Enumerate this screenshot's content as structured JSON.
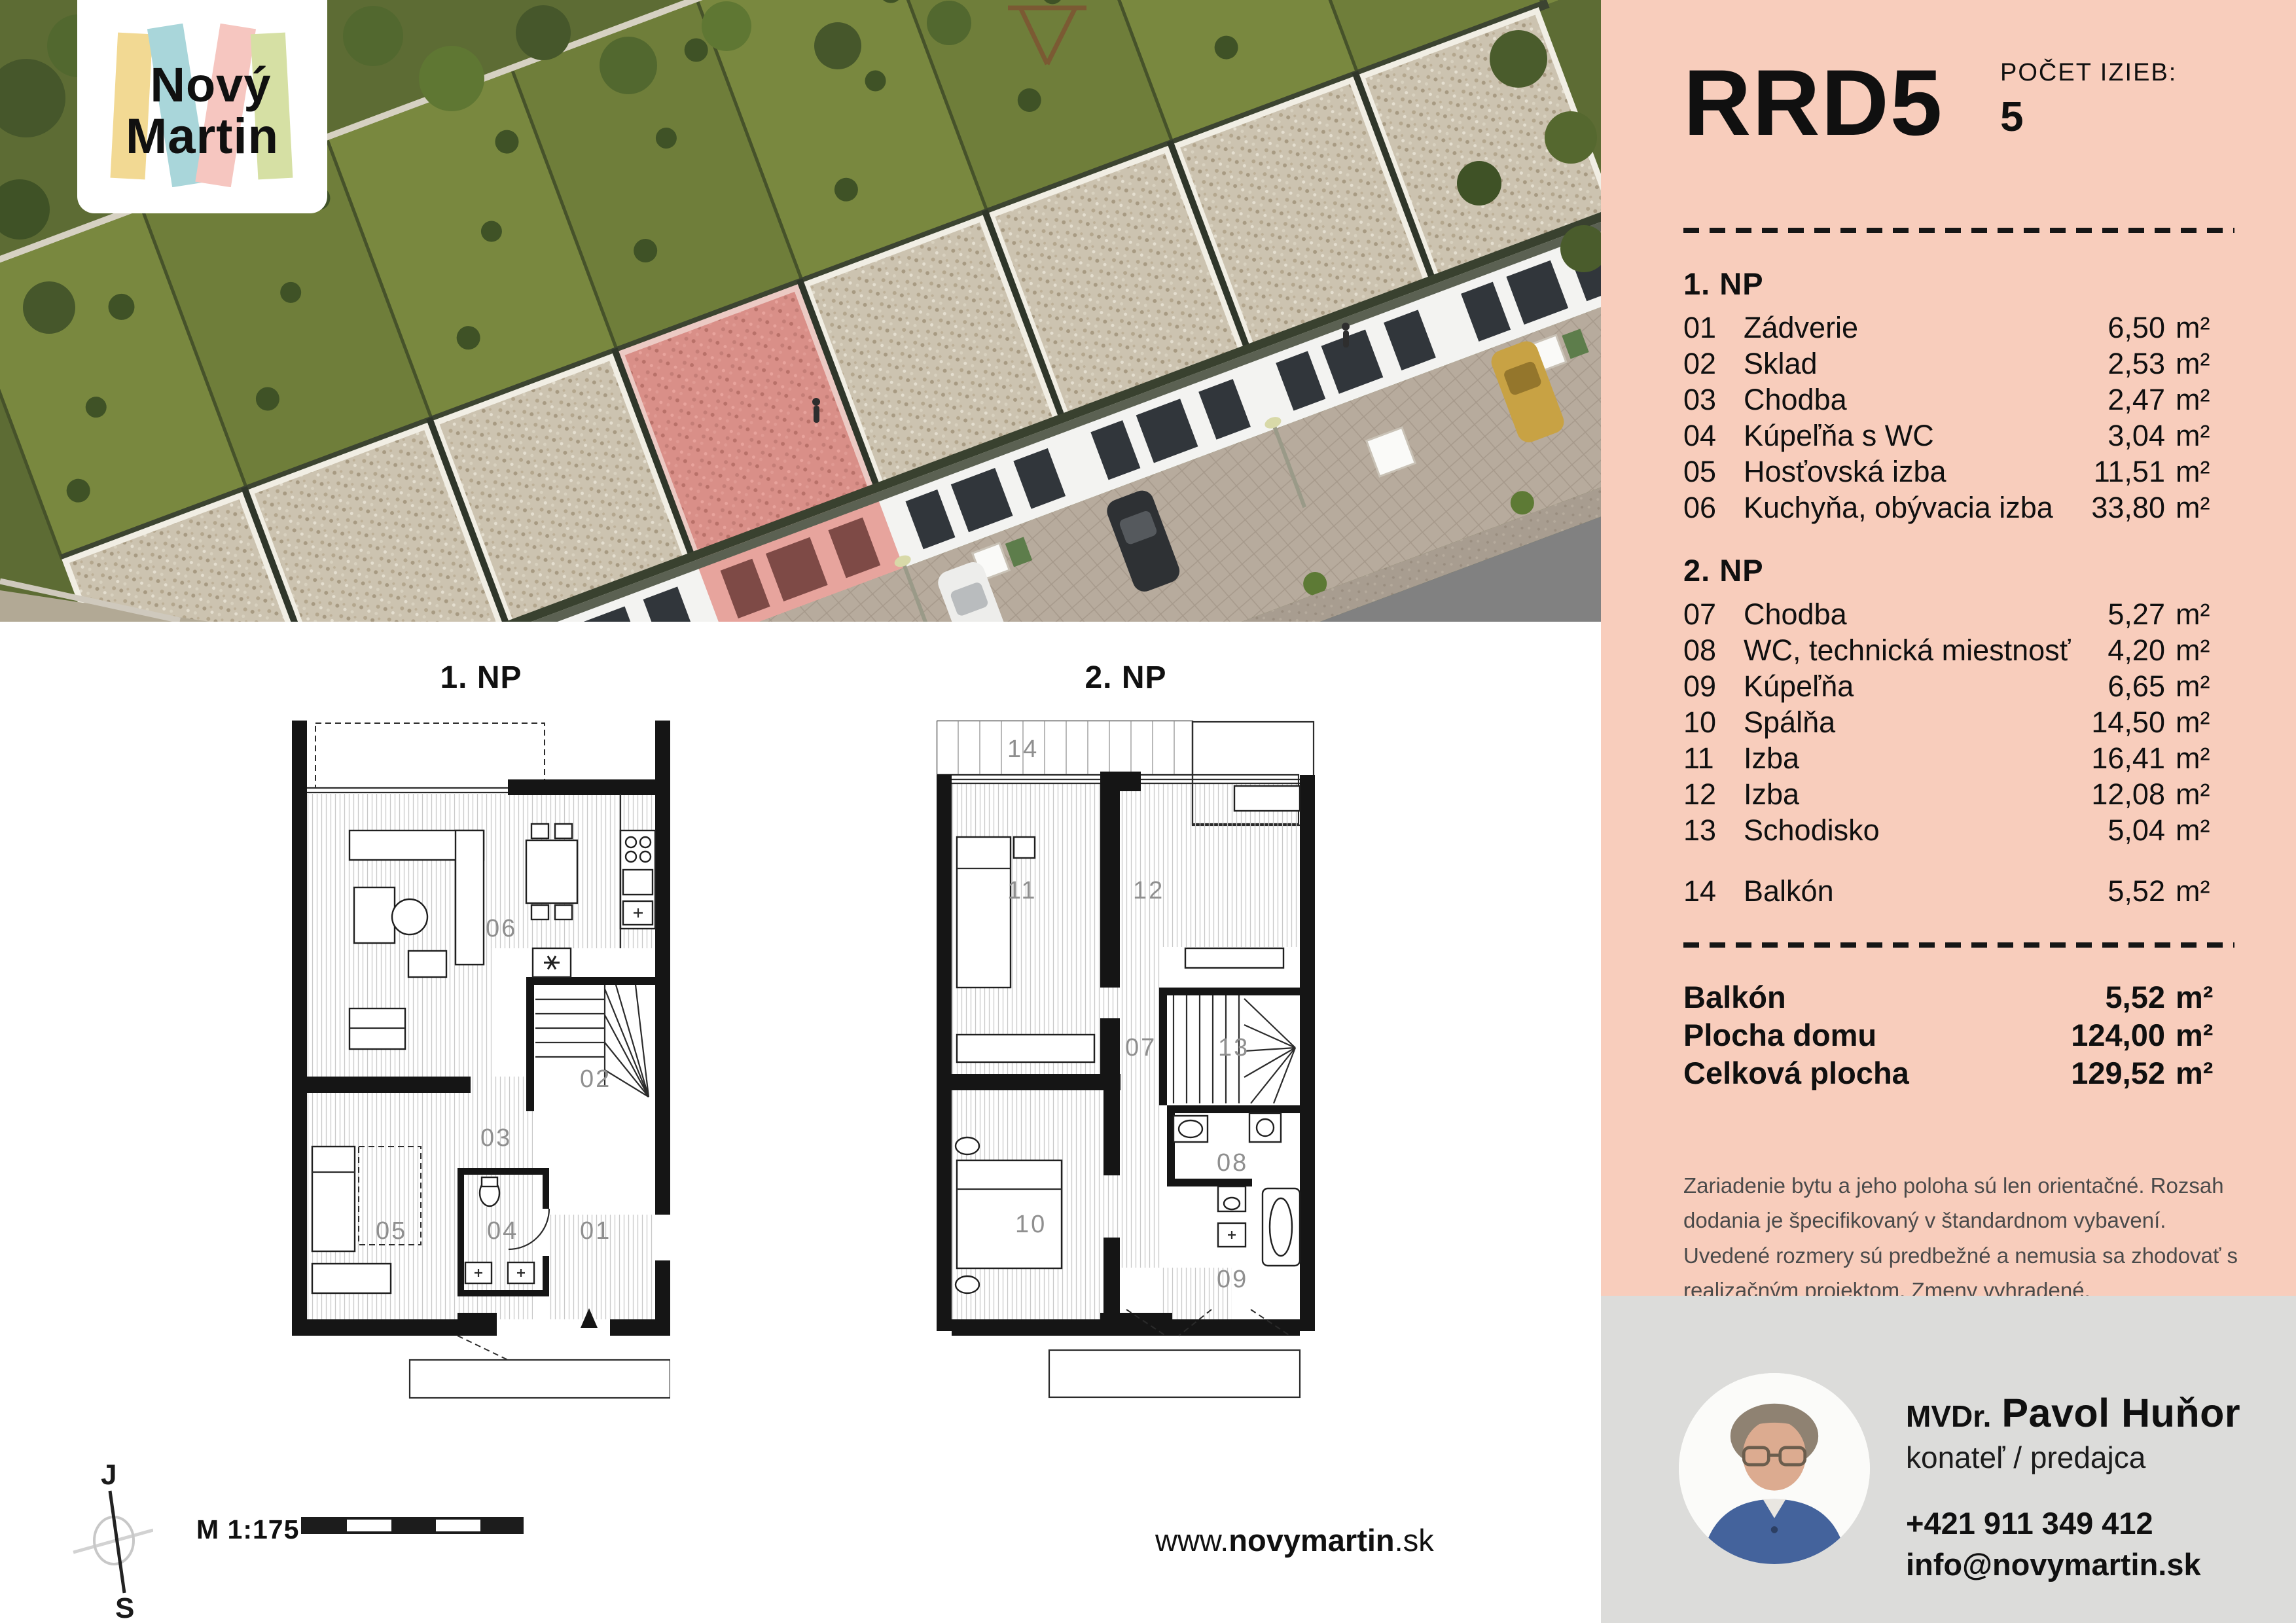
{
  "brand": {
    "name_line1": "Nový",
    "name_line2": "Martin"
  },
  "unit_header": {
    "code": "RRD5",
    "rooms_label": "POČET IZIEB:",
    "rooms_count": "5"
  },
  "area_unit": "m²",
  "floor1": {
    "title": "1. NP",
    "rows": [
      {
        "num": "01",
        "name": "Zádverie",
        "area": "6,50"
      },
      {
        "num": "02",
        "name": "Sklad",
        "area": "2,53"
      },
      {
        "num": "03",
        "name": "Chodba",
        "area": "2,47"
      },
      {
        "num": "04",
        "name": "Kúpeľňa s WC",
        "area": "3,04"
      },
      {
        "num": "05",
        "name": "Hosťovská izba",
        "area": "11,51"
      },
      {
        "num": "06",
        "name": "Kuchyňa, obývacia izba",
        "area": "33,80"
      }
    ]
  },
  "floor2": {
    "title": "2. NP",
    "rows": [
      {
        "num": "07",
        "name": "Chodba",
        "area": "5,27"
      },
      {
        "num": "08",
        "name": "WC, technická miestnosť",
        "area": "4,20"
      },
      {
        "num": "09",
        "name": "Kúpeľňa",
        "area": "6,65"
      },
      {
        "num": "10",
        "name": "Spálňa",
        "area": "14,50"
      },
      {
        "num": "11",
        "name": "Izba",
        "area": "16,41"
      },
      {
        "num": "12",
        "name": "Izba",
        "area": "12,08"
      },
      {
        "num": "13",
        "name": "Schodisko",
        "area": "5,04"
      }
    ]
  },
  "balcony_row": {
    "num": "14",
    "name": "Balkón",
    "area": "5,52"
  },
  "totals": {
    "rows": [
      {
        "label": "Balkón",
        "area": "5,52"
      },
      {
        "label": "Plocha domu",
        "area": "124,00"
      },
      {
        "label": "Celková plocha",
        "area": "129,52"
      }
    ]
  },
  "disclaimer": "Zariadenie bytu a jeho poloha sú len orientačné. Rozsah dodania je špecifikovaný v štandardnom vybavení. Uvedené rozmery sú predbežné a nemusia sa zhodovať s realizačným projektom. Zmeny vyhradené.",
  "plans": {
    "plan1_title": "1. NP",
    "plan2_title": "2. NP",
    "plan1_rooms": [
      "06",
      "02",
      "03",
      "05",
      "04",
      "01"
    ],
    "plan2_rooms": [
      "14",
      "11",
      "12",
      "07",
      "13",
      "08",
      "09",
      "10"
    ]
  },
  "compass": {
    "top": "J",
    "bottom": "S"
  },
  "scale": {
    "label": "M 1:175"
  },
  "website": {
    "prefix": "www.",
    "bold": "novymartin",
    "suffix": ".sk"
  },
  "agent": {
    "title": "MVDr.",
    "name": "Pavol Huňor",
    "role": "konateľ / predajca",
    "phone": "+421 911 349 412",
    "email": "info@novymartin.sk"
  },
  "colors": {
    "panel_pink": "#f8cdbc",
    "footer_gray": "#dcdcda",
    "highlight_house": "#df928b",
    "logo_yellow": "#f2d993",
    "logo_blue": "#a9d6da",
    "logo_pink": "#f6c6c0",
    "logo_green": "#d6e0a4"
  }
}
